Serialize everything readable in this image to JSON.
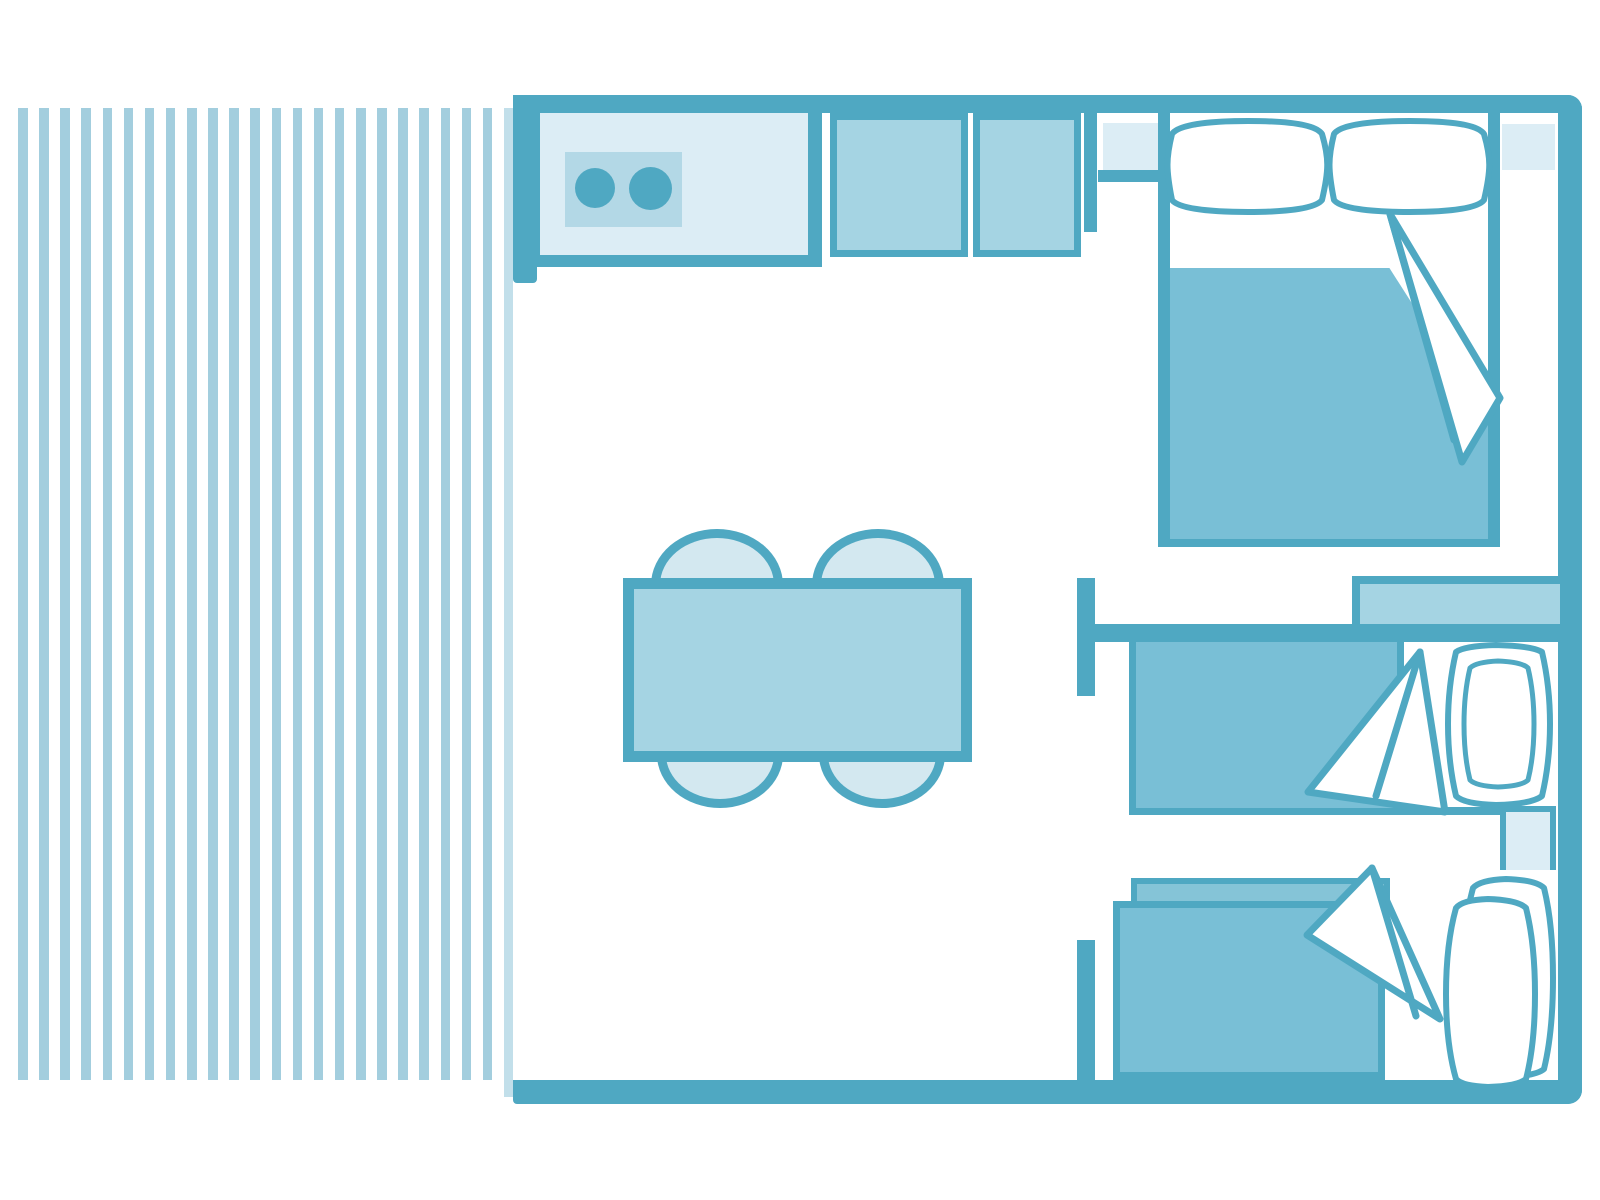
{
  "diagram_type": "floor-plan",
  "subject": "holiday-lodge-unit-top-view",
  "colors": {
    "background": "#FFFFFF",
    "wall": "#4FA8C2",
    "deck_stripe": "#A3CEDE",
    "deck_stripe_light": "#C2DFEA",
    "fill_light": "#DCEDF5",
    "fill_medium": "#A5D4E3",
    "stove_panel": "#B3D8E6",
    "chair": "#D3E8F0",
    "blanket": "#79BFD6",
    "blanket_underlay": "#85C4D7",
    "bed_linen": "#FFFFFF"
  },
  "deck": {
    "count": 24,
    "start_x": 18,
    "pitch": 21.13,
    "stripe_width": 9.5,
    "top": 108,
    "bottom": 1080,
    "last_stripe_light": true,
    "last_stripe_bottom": 1097
  },
  "rooms": [
    {
      "name": "deck-terrace"
    },
    {
      "name": "kitchen-living-area"
    },
    {
      "name": "double-bedroom"
    },
    {
      "name": "twin-bedroom"
    }
  ],
  "furniture": [
    {
      "name": "kitchen-counter",
      "room": "kitchen-living-area"
    },
    {
      "name": "stove-two-burners",
      "room": "kitchen-living-area"
    },
    {
      "name": "cabinet-1",
      "room": "kitchen-living-area"
    },
    {
      "name": "cabinet-2",
      "room": "kitchen-living-area"
    },
    {
      "name": "dining-table",
      "room": "kitchen-living-area",
      "chairs": 4
    },
    {
      "name": "double-bed",
      "room": "double-bedroom",
      "pillows": 2
    },
    {
      "name": "bedside-shelf-left",
      "room": "double-bedroom"
    },
    {
      "name": "window-shelf-right",
      "room": "double-bedroom"
    },
    {
      "name": "storage-shelf",
      "room": "twin-bedroom"
    },
    {
      "name": "single-bed-1",
      "room": "twin-bedroom",
      "pillows": 1
    },
    {
      "name": "single-bed-2",
      "room": "twin-bedroom",
      "pillows": 1
    },
    {
      "name": "bedside-table-middle",
      "room": "twin-bedroom"
    }
  ]
}
